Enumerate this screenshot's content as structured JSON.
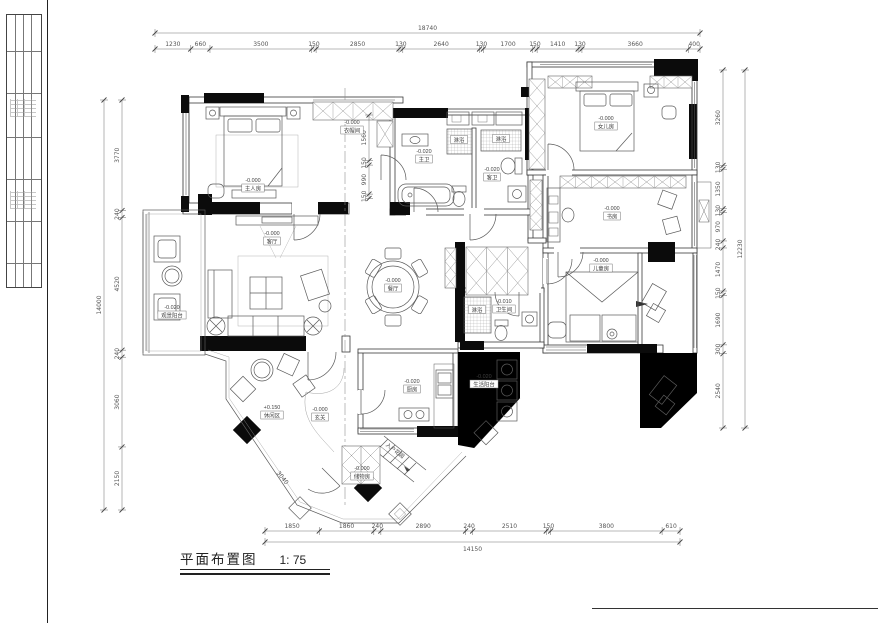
{
  "drawing_title": {
    "name": "平面布置图",
    "scale": "1: 75"
  },
  "dimensions": {
    "top": {
      "total": "18740",
      "segments": [
        "1230",
        "660",
        "3500",
        "150",
        "2850",
        "130",
        "2640",
        "130",
        "1700",
        "150",
        "1410",
        "130",
        "3660",
        "400"
      ]
    },
    "bottom": {
      "total": "14150",
      "segments": [
        "1850",
        "1860",
        "240",
        "2890",
        "240",
        "2510",
        "150",
        "3800",
        "610"
      ]
    },
    "left": {
      "total": "14000",
      "segments": [
        "3770",
        "240",
        "4520",
        "240",
        "3060",
        "2150"
      ]
    },
    "right": {
      "total": "12230",
      "segments": [
        "3260",
        "130",
        "1350",
        "130",
        "970",
        "240",
        "1470",
        "150",
        "1690",
        "300",
        "2540"
      ]
    },
    "closet_chain": [
      "1560",
      "150",
      "990",
      "150"
    ],
    "diagonal_wall": "3040"
  },
  "rooms": [
    {
      "name": "主人房",
      "level": "-0.000"
    },
    {
      "name": "衣帽间",
      "level": "-0.000"
    },
    {
      "name": "主卫",
      "level": "-0.020"
    },
    {
      "name": "客卫",
      "level": "-0.020"
    },
    {
      "name": "女儿房",
      "level": "-0.000"
    },
    {
      "name": "书房",
      "level": "-0.000"
    },
    {
      "name": "儿童房",
      "level": "-0.000"
    },
    {
      "name": "客厅",
      "level": "-0.000"
    },
    {
      "name": "观景阳台",
      "level": "-0.020"
    },
    {
      "name": "餐厅",
      "level": "-0.000"
    },
    {
      "name": "厨房",
      "level": "-0.020"
    },
    {
      "name": "生活阳台",
      "level": "-0.020"
    },
    {
      "name": "卫生间",
      "level": "-0.010"
    },
    {
      "name": "休闲区",
      "level": "+0.150"
    },
    {
      "name": "玄关",
      "level": "-0.000"
    },
    {
      "name": "储物房",
      "level": "-0.000"
    }
  ],
  "fixture_labels": [
    "淋浴",
    "淋浴",
    "淋浴"
  ],
  "area_labels": [
    "入户花园"
  ]
}
